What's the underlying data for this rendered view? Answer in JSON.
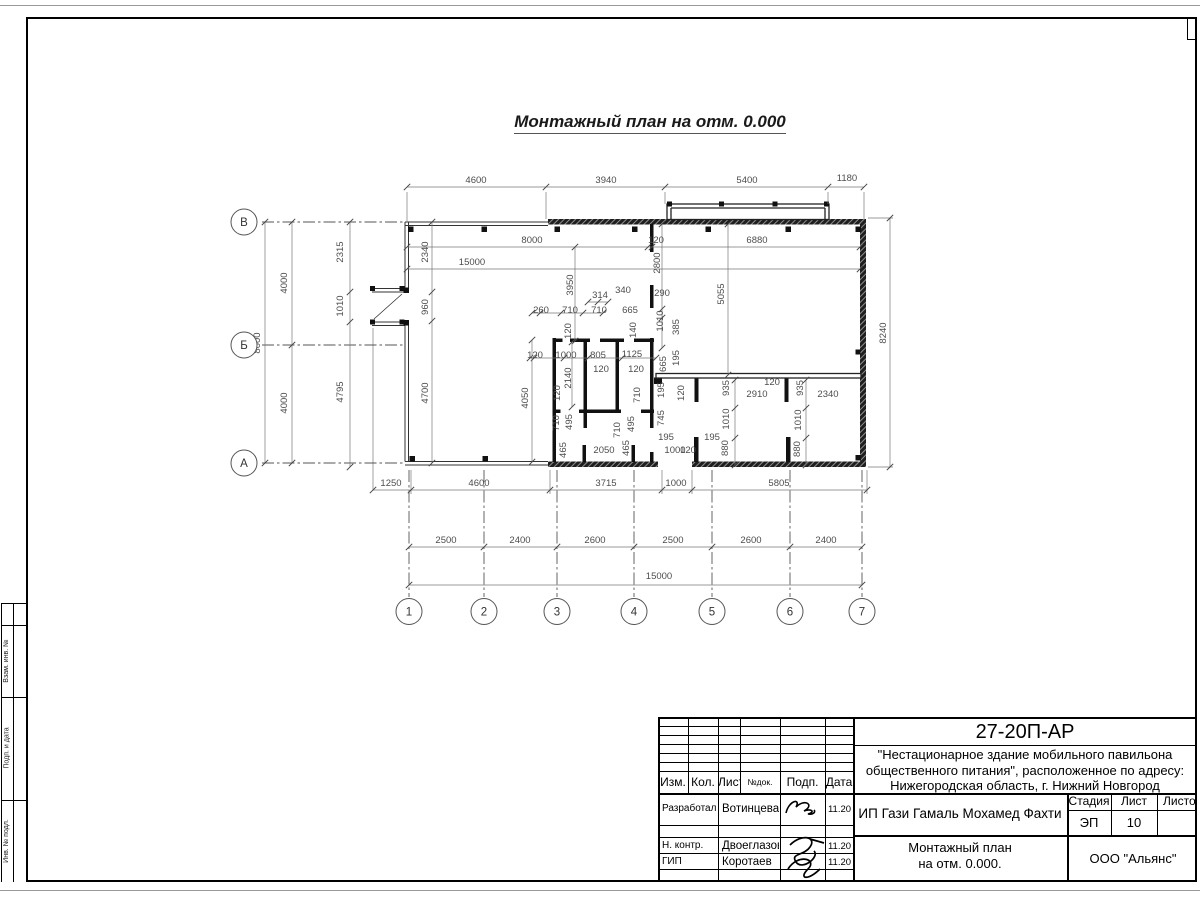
{
  "page": {
    "drawing_title": "Монтажный план на отм. 0.000"
  },
  "plan": {
    "axis_rows": [
      {
        "label": "В",
        "x": 244,
        "y": 222
      },
      {
        "label": "Б",
        "x": 244,
        "y": 345
      },
      {
        "label": "А",
        "x": 244,
        "y": 463
      }
    ],
    "axis_cols": [
      {
        "label": "1",
        "x": 409
      },
      {
        "label": "2",
        "x": 484
      },
      {
        "label": "3",
        "x": 557
      },
      {
        "label": "4",
        "x": 634
      },
      {
        "label": "5",
        "x": 712
      },
      {
        "label": "6",
        "x": 790
      },
      {
        "label": "7",
        "x": 862
      }
    ],
    "dims": [
      {
        "t": "4600",
        "x": 476,
        "y": 183,
        "v": 0
      },
      {
        "t": "3940",
        "x": 606,
        "y": 183,
        "v": 0
      },
      {
        "t": "5400",
        "x": 747,
        "y": 183,
        "v": 0
      },
      {
        "t": "1180",
        "x": 847,
        "y": 181,
        "v": 0
      },
      {
        "t": "8000",
        "x": 532,
        "y": 243,
        "v": 0
      },
      {
        "t": "120",
        "x": 656,
        "y": 243,
        "v": 0
      },
      {
        "t": "6880",
        "x": 757,
        "y": 243,
        "v": 0
      },
      {
        "t": "15000",
        "x": 472,
        "y": 265,
        "v": 0
      },
      {
        "t": "2340",
        "x": 428,
        "y": 252,
        "v": 1
      },
      {
        "t": "960",
        "x": 428,
        "y": 307,
        "v": 1
      },
      {
        "t": "4700",
        "x": 428,
        "y": 393,
        "v": 1
      },
      {
        "t": "2315",
        "x": 343,
        "y": 252,
        "v": 1
      },
      {
        "t": "1010",
        "x": 343,
        "y": 306,
        "v": 1
      },
      {
        "t": "4795",
        "x": 343,
        "y": 392,
        "v": 1
      },
      {
        "t": "8000",
        "x": 260,
        "y": 343,
        "v": 1
      },
      {
        "t": "4000",
        "x": 287,
        "y": 283,
        "v": 1
      },
      {
        "t": "4000",
        "x": 287,
        "y": 403,
        "v": 1
      },
      {
        "t": "3950",
        "x": 573,
        "y": 285,
        "v": 1
      },
      {
        "t": "2800",
        "x": 660,
        "y": 263,
        "v": 1
      },
      {
        "t": "290",
        "x": 662,
        "y": 296,
        "v": 0
      },
      {
        "t": "5055",
        "x": 724,
        "y": 294,
        "v": 1
      },
      {
        "t": "8240",
        "x": 886,
        "y": 333,
        "v": 1
      },
      {
        "t": "314",
        "x": 600,
        "y": 298,
        "v": 0
      },
      {
        "t": "340",
        "x": 623,
        "y": 293,
        "v": 0
      },
      {
        "t": "260",
        "x": 541,
        "y": 313,
        "v": 0
      },
      {
        "t": "710",
        "x": 570,
        "y": 313,
        "v": 0
      },
      {
        "t": "710",
        "x": 599,
        "y": 313,
        "v": 0
      },
      {
        "t": "665",
        "x": 630,
        "y": 313,
        "v": 0
      },
      {
        "t": "140",
        "x": 636,
        "y": 330,
        "v": 1
      },
      {
        "t": "1010",
        "x": 663,
        "y": 321,
        "v": 1
      },
      {
        "t": "385",
        "x": 679,
        "y": 327,
        "v": 1
      },
      {
        "t": "120",
        "x": 571,
        "y": 331,
        "v": 1
      },
      {
        "t": "120",
        "x": 535,
        "y": 358,
        "v": 0
      },
      {
        "t": "1000",
        "x": 566,
        "y": 358,
        "v": 0
      },
      {
        "t": "805",
        "x": 598,
        "y": 358,
        "v": 0
      },
      {
        "t": "1125",
        "x": 632,
        "y": 357,
        "v": 0
      },
      {
        "t": "665",
        "x": 666,
        "y": 364,
        "v": 1
      },
      {
        "t": "195",
        "x": 679,
        "y": 358,
        "v": 1
      },
      {
        "t": "120",
        "x": 601,
        "y": 372,
        "v": 0
      },
      {
        "t": "120",
        "x": 636,
        "y": 372,
        "v": 0
      },
      {
        "t": "2140",
        "x": 571,
        "y": 378,
        "v": 1
      },
      {
        "t": "4050",
        "x": 528,
        "y": 398,
        "v": 1
      },
      {
        "t": "120",
        "x": 560,
        "y": 393,
        "v": 1
      },
      {
        "t": "710",
        "x": 640,
        "y": 395,
        "v": 1
      },
      {
        "t": "195",
        "x": 664,
        "y": 390,
        "v": 1
      },
      {
        "t": "120",
        "x": 684,
        "y": 393,
        "v": 1
      },
      {
        "t": "710",
        "x": 559,
        "y": 423,
        "v": 1
      },
      {
        "t": "495",
        "x": 572,
        "y": 422,
        "v": 1
      },
      {
        "t": "710",
        "x": 620,
        "y": 430,
        "v": 1
      },
      {
        "t": "495",
        "x": 634,
        "y": 424,
        "v": 1
      },
      {
        "t": "745",
        "x": 664,
        "y": 418,
        "v": 1
      },
      {
        "t": "465",
        "x": 566,
        "y": 450,
        "v": 1
      },
      {
        "t": "2050",
        "x": 604,
        "y": 453,
        "v": 0
      },
      {
        "t": "465",
        "x": 629,
        "y": 448,
        "v": 1
      },
      {
        "t": "195",
        "x": 666,
        "y": 440,
        "v": 0
      },
      {
        "t": "1000",
        "x": 675,
        "y": 453,
        "v": 0
      },
      {
        "t": "120",
        "x": 688,
        "y": 453,
        "v": 0
      },
      {
        "t": "195",
        "x": 712,
        "y": 440,
        "v": 0
      },
      {
        "t": "935",
        "x": 729,
        "y": 388,
        "v": 1
      },
      {
        "t": "120",
        "x": 772,
        "y": 385,
        "v": 0
      },
      {
        "t": "2910",
        "x": 757,
        "y": 397,
        "v": 0
      },
      {
        "t": "935",
        "x": 803,
        "y": 388,
        "v": 1
      },
      {
        "t": "2340",
        "x": 828,
        "y": 397,
        "v": 0
      },
      {
        "t": "1010",
        "x": 729,
        "y": 419,
        "v": 1
      },
      {
        "t": "1010",
        "x": 801,
        "y": 420,
        "v": 1
      },
      {
        "t": "880",
        "x": 728,
        "y": 448,
        "v": 1
      },
      {
        "t": "880",
        "x": 800,
        "y": 449,
        "v": 1
      },
      {
        "t": "1250",
        "x": 391,
        "y": 486,
        "v": 0
      },
      {
        "t": "4600",
        "x": 479,
        "y": 486,
        "v": 0
      },
      {
        "t": "3715",
        "x": 606,
        "y": 486,
        "v": 0
      },
      {
        "t": "1000",
        "x": 676,
        "y": 486,
        "v": 0
      },
      {
        "t": "5805",
        "x": 779,
        "y": 486,
        "v": 0
      },
      {
        "t": "2500",
        "x": 446,
        "y": 543,
        "v": 0
      },
      {
        "t": "2400",
        "x": 520,
        "y": 543,
        "v": 0
      },
      {
        "t": "2600",
        "x": 595,
        "y": 543,
        "v": 0
      },
      {
        "t": "2500",
        "x": 673,
        "y": 543,
        "v": 0
      },
      {
        "t": "2600",
        "x": 751,
        "y": 543,
        "v": 0
      },
      {
        "t": "2400",
        "x": 826,
        "y": 543,
        "v": 0
      },
      {
        "t": "15000",
        "x": 659,
        "y": 579,
        "v": 0
      }
    ]
  },
  "frame": {
    "side_labels": [
      "Взам. инв. №",
      "Подп. и дата",
      "Инв. № подл."
    ]
  },
  "stamp": {
    "doc_number": "27-20П-АР",
    "project_line1": "\"Нестационарное здание мобильного павильона",
    "project_line2": "общественного питания\", расположенное по адресу:",
    "project_line3": "Нижегородская область, г. Нижний Новгород",
    "rev_headers": {
      "izm": "Изм.",
      "kol": "Кол.",
      "list": "Лист",
      "ndok": "№док.",
      "podp": "Подп.",
      "data": "Дата"
    },
    "rows": [
      {
        "role": "Разработал",
        "name": "Вотинцева",
        "date": "11.20"
      },
      {
        "role": "Н. контр.",
        "name": "Двоеглазов",
        "date": "11.20"
      },
      {
        "role": "ГИП",
        "name": "Коротаев",
        "date": "11.20"
      }
    ],
    "client": "ИП Гази Гамаль Мохамед Фахти",
    "stage_label": "Стадия",
    "sheet_label": "Лист",
    "sheets_label": "Листов",
    "stage": "ЭП",
    "sheet": "10",
    "sheets": "",
    "drawing_title_line1": "Монтажный план",
    "drawing_title_line2": "на отм. 0.000.",
    "company": "ООО \"Альянс\""
  }
}
